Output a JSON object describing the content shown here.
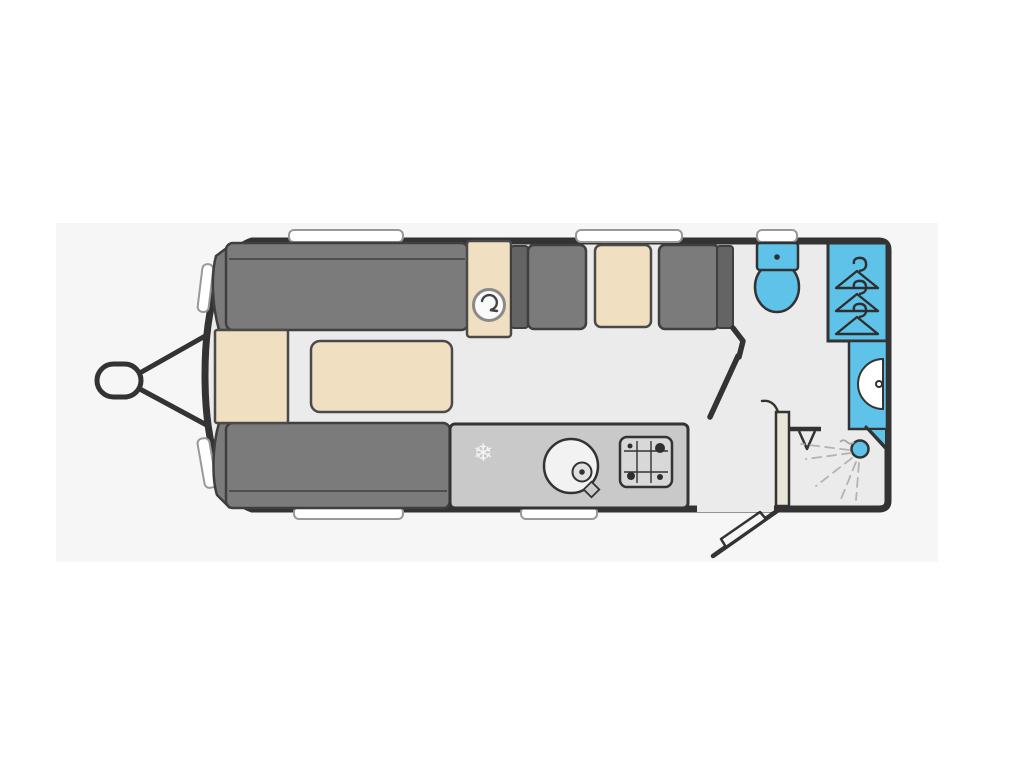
{
  "image_type": "caravan-floorplan",
  "title": "",
  "colors": {
    "page": "#ffffff",
    "canvas": "#f6f6f6",
    "floor": "#ebebeb",
    "wall": "#333333",
    "seat": "#7b7b7b",
    "seat-dark": "#646464",
    "seat-border": "#3f3f3f",
    "beige": "#f0dfc1",
    "beige-border": "#4a4a4a",
    "counter": "#c9c9c9",
    "counter-inner": "#d8d8d8",
    "blue": "#5ec2e9",
    "white": "#ffffff",
    "window-border": "#999999",
    "spray": "#b3b3b3",
    "slider-fill": "#e9e5d9"
  },
  "icons": {
    "snowflake": "❄",
    "fan_heater": "swirl-in-circle",
    "hangers": "coat-hanger-x3",
    "burners": "four-burner-hob",
    "spray": "shower-spray-lines"
  },
  "plan": {
    "vehicle": "touring caravan",
    "exterior": [
      "tow-hitch",
      "a-frame",
      "front-windows",
      "top-windows",
      "bottom-windows",
      "entrance-door"
    ],
    "front_lounge": [
      "front-chest",
      "top-sofa",
      "bottom-sofa",
      "coffee-table",
      "cabinet-with-heater"
    ],
    "dinette": [
      "left-armrest",
      "left-seat",
      "dinette-table",
      "right-seat",
      "right-armrest"
    ],
    "kitchen": [
      "fridge-freezer",
      "round-sink-with-tap",
      "four-burner-hob",
      "worktop"
    ],
    "washroom": [
      "toilet-with-cistern",
      "wardrobe",
      "vanity-basin",
      "corner-shower",
      "sliding-door",
      "partition-door"
    ]
  }
}
